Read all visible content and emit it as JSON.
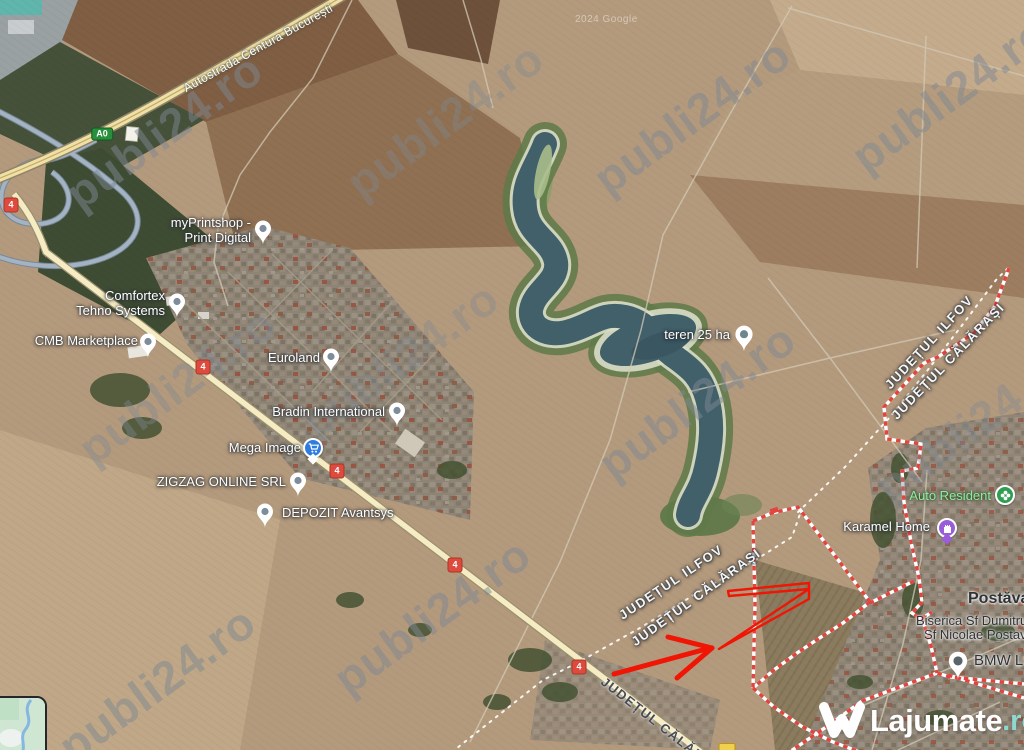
{
  "watermark": "publi24.ro",
  "attribution": "2024 Google",
  "road_label": "Autostrada Centura București",
  "badges": {
    "a0": "A0",
    "dn4": "4"
  },
  "county": {
    "ilfov": "JUDEȚUL ILFOV",
    "calarasi": "JUDEȚUL CĂLĂRAȘI"
  },
  "poi": {
    "myprintshop_l1": "myPrintshop -",
    "myprintshop_l2": "Print Digital",
    "comfortex_l1": "Comfortex",
    "comfortex_l2": "Tehno Systems",
    "cmb": "CMB Marketplace",
    "euroland": "Euroland",
    "bradin": "Bradin International",
    "mega": "Mega Image",
    "zigzag": "ZIGZAG ONLINE SRL",
    "depozit": "DEPOZIT Avantsys",
    "teren": "teren 25 ha",
    "auto_resident": "Auto Resident",
    "karamel": "Karamel Home",
    "postavari": "Postăvari",
    "biserica_l1": "Biserica Sf Dumitru",
    "biserica_l2": "Sf Nicolae Postav",
    "bmw": "BMW LSD"
  },
  "logo": {
    "name": "Lajumate",
    "tld": ".ro"
  },
  "colors": {
    "boundary_red": "#e2453f",
    "arrow_red": "#f01505",
    "water": "#41606a",
    "highway_yellow": "#f0e0a4",
    "logo_teal": "#8fd8d2"
  }
}
